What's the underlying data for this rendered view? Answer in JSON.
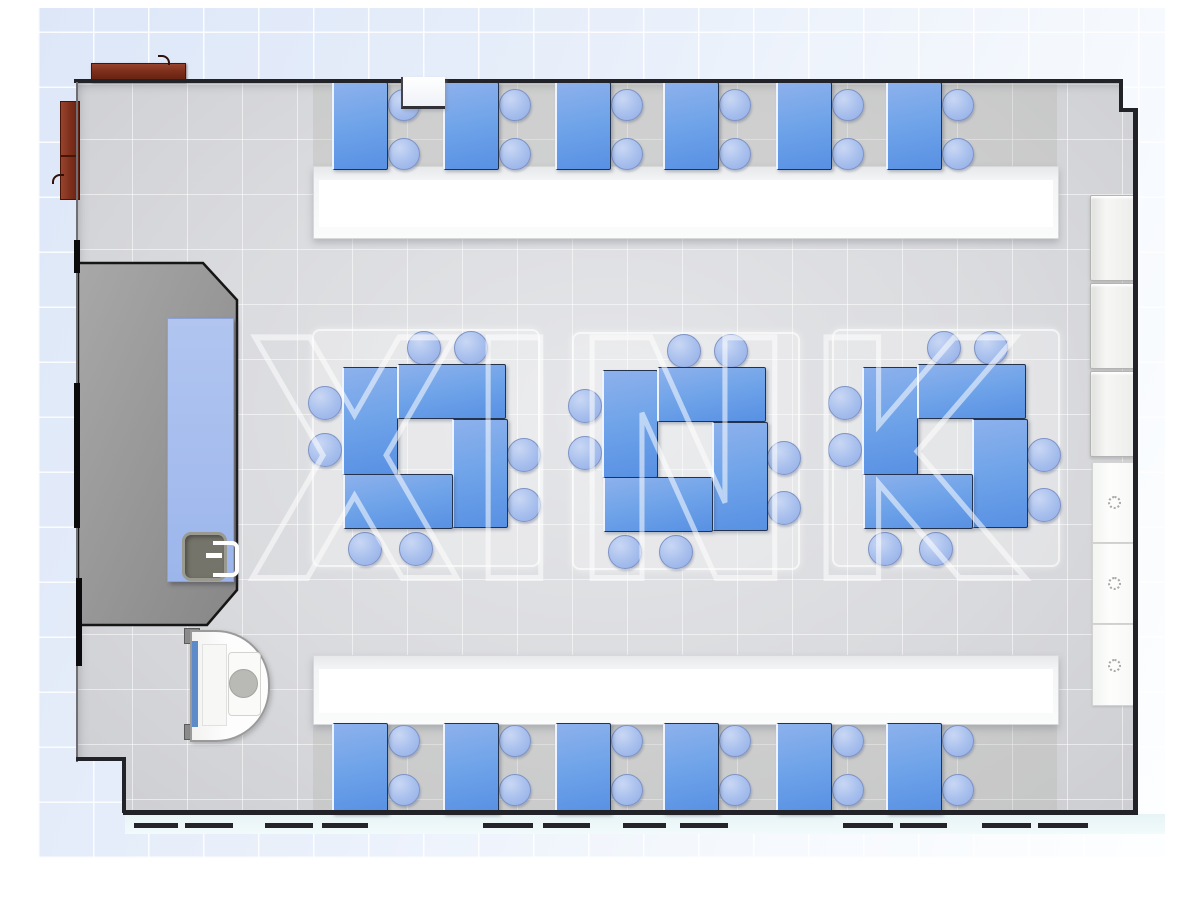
{
  "watermark": {
    "text": "XINK"
  },
  "scene": {
    "type": "classroom-floor-plan-top-view",
    "palette": {
      "desk_blue": "#6ea3e9",
      "chair_blue": "#a7bfed",
      "floor_gray": "#dadbde",
      "platform_gray": "#9a9a9a",
      "counter_white": "#ffffff",
      "cabinet_brown": "#7c2e1b",
      "wall_dark": "#222328",
      "exterior_tint": "#e7eefa",
      "walkway_tint": "#e7f4f6",
      "watermark_white": "#ffffff"
    },
    "icons": {
      "cabinet_knob": "dotted-circle"
    },
    "inventory": {
      "top_row_desks": 6,
      "bottom_row_desks": 6,
      "cluster_groups": 3,
      "desks_per_cluster": 4,
      "chairs_per_cluster": 8,
      "chairs_per_row_desk": 2,
      "right_wall_cabinets": 6,
      "brown_cabinets": 2,
      "counters": 2,
      "teacher_platform": 1,
      "demo_table_with_sink": 1,
      "sink_station": 1
    }
  },
  "top_row": {
    "desk_xs": [
      332,
      443,
      555,
      663,
      776,
      886
    ],
    "desk_y": 82,
    "desk_w": 53,
    "desk_h": 86,
    "chair_dx": 71,
    "chair_cys": [
      104,
      153
    ],
    "chair_r": 15
  },
  "bottom_row": {
    "desk_xs": [
      332,
      443,
      555,
      663,
      776,
      886
    ],
    "desk_y": 723,
    "desk_w": 53,
    "desk_h": 89,
    "chair_dx": 71,
    "chair_cys": [
      740,
      789
    ],
    "chair_r": 15
  },
  "clusters": {
    "centers": [
      [
        424,
        446
      ],
      [
        684,
        449
      ],
      [
        944,
        446
      ]
    ],
    "desk_rects": [
      [
        -82,
        -79,
        53,
        106
      ],
      [
        -27,
        -82,
        106,
        53
      ],
      [
        28,
        -27,
        53,
        107
      ],
      [
        -81,
        28,
        107,
        53
      ]
    ],
    "chair_offsets": [
      [
        -1,
        -99
      ],
      [
        46,
        -99
      ],
      [
        99,
        8
      ],
      [
        99,
        58
      ],
      [
        -60,
        102
      ],
      [
        -9,
        102
      ],
      [
        -100,
        -44
      ],
      [
        -100,
        3
      ]
    ],
    "chair_r": 16,
    "mat": {
      "w": 224,
      "h": 234
    }
  },
  "counters": [
    {
      "x": 313,
      "y": 166,
      "w": 744,
      "h": 71
    },
    {
      "x": 313,
      "y": 655,
      "w": 744,
      "h": 68
    }
  ],
  "right_cabinets": {
    "upper": [
      {
        "x": 1090,
        "y": 195,
        "w": 43,
        "h": 84
      },
      {
        "x": 1090,
        "y": 283,
        "w": 43,
        "h": 84
      },
      {
        "x": 1090,
        "y": 371,
        "w": 43,
        "h": 84
      }
    ],
    "lower": [
      {
        "x": 1092,
        "y": 462,
        "w": 43,
        "h": 79
      },
      {
        "x": 1092,
        "y": 543,
        "w": 43,
        "h": 79
      },
      {
        "x": 1092,
        "y": 624,
        "w": 43,
        "h": 80
      }
    ]
  },
  "row_bands": [
    {
      "x": 313,
      "y": 84,
      "w": 744,
      "h": 83
    },
    {
      "x": 313,
      "y": 723,
      "w": 744,
      "h": 88
    }
  ],
  "bottom_dashes": [
    [
      134,
      44
    ],
    [
      185,
      48
    ],
    [
      265,
      48
    ],
    [
      322,
      46
    ],
    [
      483,
      50
    ],
    [
      543,
      47
    ],
    [
      623,
      43
    ],
    [
      680,
      48
    ],
    [
      843,
      50
    ],
    [
      900,
      47
    ],
    [
      982,
      49
    ],
    [
      1038,
      50
    ]
  ]
}
